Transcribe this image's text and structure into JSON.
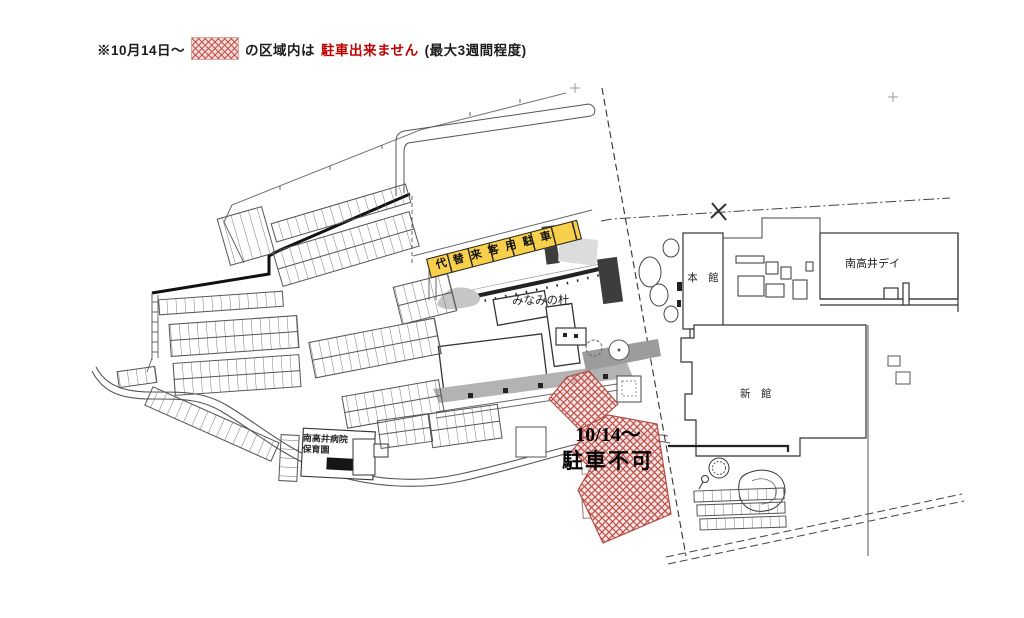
{
  "note": {
    "prefix": "※10月14日～",
    "swatch_meaning": "red-crosshatch-no-parking-area",
    "middle": "の区域内は",
    "highlight": "駐車出来ません",
    "suffix": "(最大3週間程度)"
  },
  "map": {
    "labels": {
      "substitute_parking": "代替来客用駐車",
      "minami_no_mori": "みなみの杜",
      "main_building": "本　館",
      "minamidai_day": "南高井デイ",
      "new_building": "新　館",
      "nursery_line1": "南高井病院",
      "nursery_line2": "保育園",
      "closed_date": "10/14～",
      "closed_text": "駐車不可"
    },
    "colors": {
      "hatch_red": "#bf4e47",
      "highlight_red": "#c00000",
      "band_yellow": "#f8cf4a",
      "walkway_gray": "#b3b3b3",
      "road_dark_gray": "#9c9c9c"
    }
  }
}
